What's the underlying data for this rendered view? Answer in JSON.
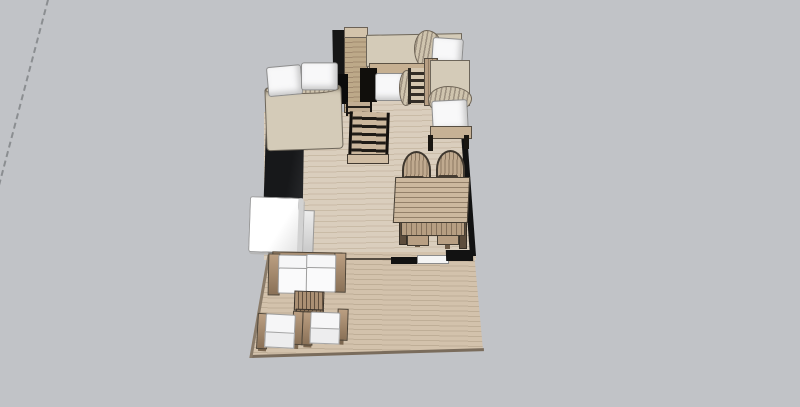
{
  "viewport": {
    "background": "#c1c3c7",
    "width": 800,
    "height": 407
  },
  "axis_guide": {
    "style": "dashed",
    "color": "#7e8184"
  },
  "palette": {
    "floor_light": "#dacebd",
    "floor_dark": "#c9bba6",
    "deck_light": "#d3c2ac",
    "deck_dark": "#bfae97",
    "wall": "#121212",
    "counter": "#1b1c1d",
    "wood_light": "#c3ad92",
    "wood_dark": "#8d775e",
    "fabric": "#d4cbb8",
    "cushion": "#f6f6f7",
    "sill": "#f4f4f4"
  },
  "labels": {
    "viewport": "3D floor plan viewport",
    "axis_guide": "dashed axis guide line",
    "interior_floor": "wood plank floor",
    "patio_deck": "patio deck",
    "double_bed": "double bed",
    "wardrobe": "wardrobe column",
    "loft_bed": "loft bed",
    "bunk_bed": "bunk bed",
    "ladder": "bunk ladder",
    "corner_bed": "corner bed",
    "staircase": "staircase",
    "kitchen_counter": "kitchen counter",
    "refrigerator": "refrigerator",
    "countertop": "countertop",
    "dining_table": "dining table",
    "dining_chair": "dining chair",
    "sofa": "outdoor sofa",
    "coffee_table": "slatted coffee table",
    "armchair": "outdoor armchair",
    "window_sill": "window sill",
    "wall": "wall segment"
  }
}
